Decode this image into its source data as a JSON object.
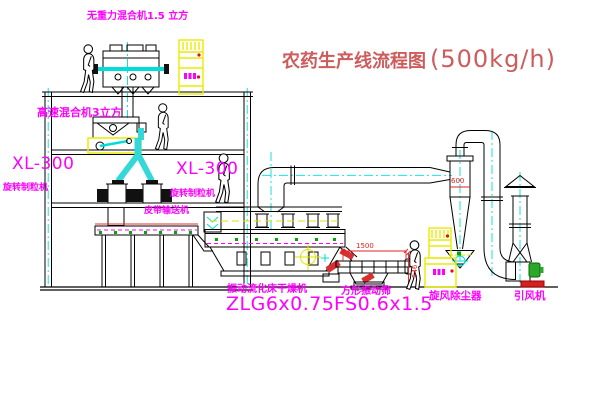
{
  "title": {
    "text": "农药生产线流程图",
    "capacity": "(500kg/h)"
  },
  "labels": {
    "weightless_mixer": "无重力混合机1.5 立方",
    "high_speed_mixer": "高速混合机3立方",
    "granulator_left_model": "XL-300",
    "granulator_left_name": "旋转制粒机",
    "granulator_mid_model": "XL-300",
    "granulator_mid_name": "旋转制粒机",
    "belt_conveyor": "皮带输送机",
    "dryer_name": "振动流化床干燥机",
    "dryer_model": "ZLG6x0.75",
    "sieve_name": "方形振动筛",
    "sieve_model": "FS0.6x1.5",
    "cyclone_name": "旋风除尘器",
    "fan_name": "引风机"
  },
  "dimensions": {
    "sieve_length": "1500",
    "sieve_height": "546",
    "cyclone_diameter": "600"
  },
  "colors": {
    "label_magenta": "#ff00ff",
    "dimension_red": "#e02020",
    "title_red": "#cd5c5c",
    "cabinet_yellow": "#ebeb00",
    "pipe_cyan": "#00dcdc",
    "dot_green": "#00a800",
    "base_red": "#d42020",
    "line_black": "#000000",
    "background": "#ffffff"
  }
}
